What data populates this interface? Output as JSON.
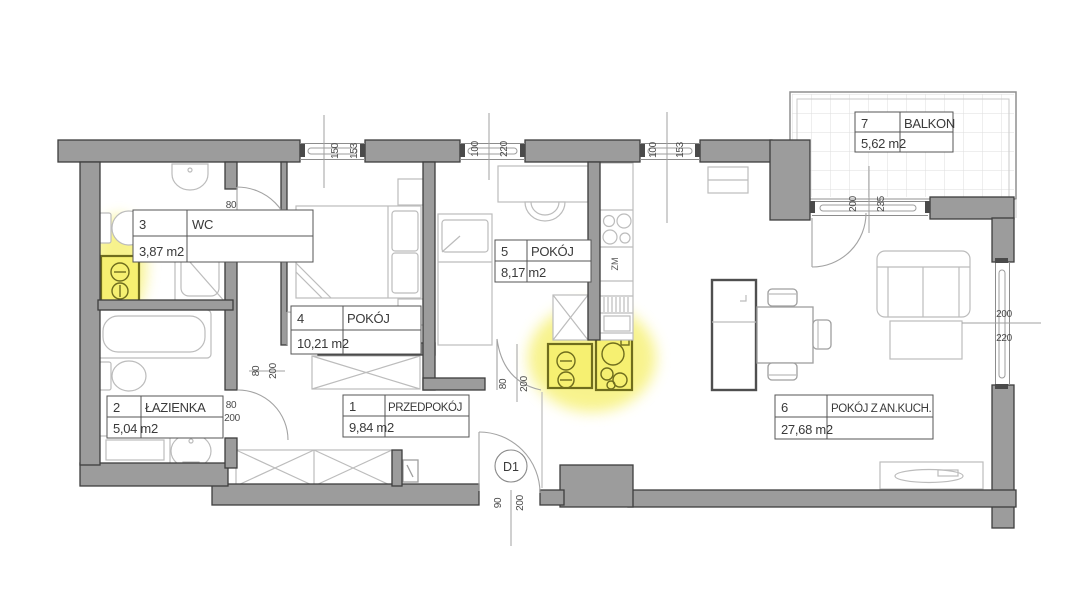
{
  "plan": {
    "rooms": [
      {
        "number": "1",
        "name": "PRZEDPOKÓJ",
        "area": "9,84 m2"
      },
      {
        "number": "2",
        "name": "ŁAZIENKA",
        "area": "5,04 m2"
      },
      {
        "number": "3",
        "name": "WC",
        "area": "3,87 m2"
      },
      {
        "number": "4",
        "name": "POKÓJ",
        "area": "10,21 m2"
      },
      {
        "number": "5",
        "name": "POKÓJ",
        "area": "8,17 m2"
      },
      {
        "number": "6",
        "name": "POKÓJ Z AN.KUCH.",
        "area": "27,68 m2"
      },
      {
        "number": "7",
        "name": "BALKON",
        "area": "5,62 m2"
      }
    ],
    "doors": {
      "entrance": {
        "label": "D1",
        "width": "90",
        "height": "200"
      },
      "wc": {
        "width": "80",
        "height": "200"
      },
      "bathroom": {
        "width": "80",
        "height": "200"
      },
      "room4": {
        "width": "80",
        "height": "200"
      },
      "kitchen": {
        "width": "80",
        "height": "200"
      },
      "balcony": {
        "width": "200",
        "height": "235"
      }
    },
    "windows": {
      "top1": {
        "width": "150",
        "height": "153"
      },
      "top2": {
        "width": "100",
        "height": "220"
      },
      "top3": {
        "width": "100",
        "height": "153"
      },
      "right": {
        "width": "200",
        "height": "220"
      }
    },
    "labels": {
      "dishwasher": "ZM"
    },
    "colors": {
      "wall": "#9c9c9c",
      "highlight": "#f6f071",
      "wall_outline": "#3e3e3e"
    }
  }
}
